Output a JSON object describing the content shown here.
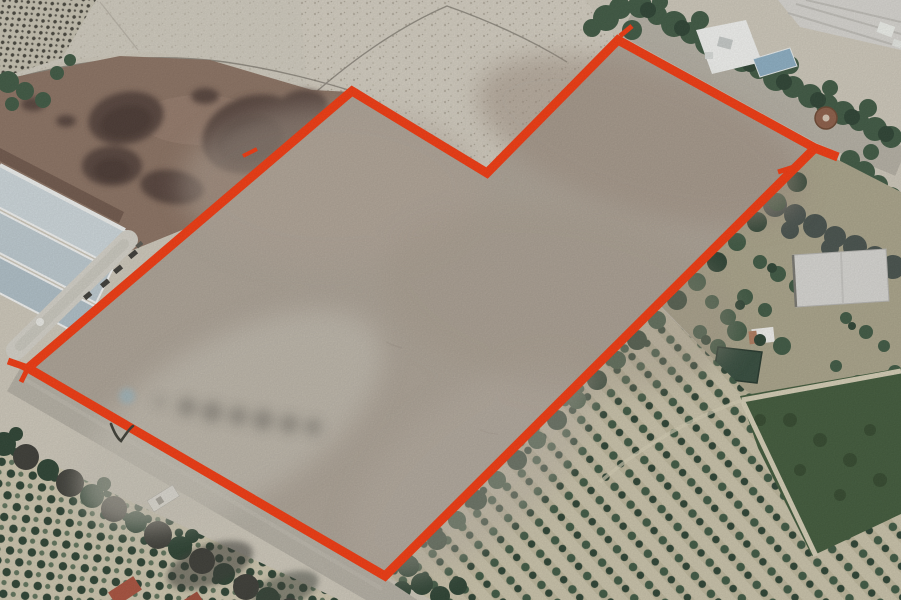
{
  "meta": {
    "width": 901,
    "height": 600,
    "description": "Aerial satellite view of farmland with a large land parcel outlined in red"
  },
  "colors": {
    "accent_red": "#f2380e",
    "parcel_base": "#aca295",
    "ground_pale": "#cdc7b9",
    "ground_speckle": "#d2ccbf",
    "field_brown": "#8a7161",
    "mud_dark": "#55423a",
    "mud_deep": "#43332d",
    "tree_green": "#3d5741",
    "tree_dark": "#2b4131",
    "orchard_ground": "#c9c2a9",
    "olive_ground": "#a9a389",
    "road_grey": "#b4afa3",
    "roof_blue": "#ccd6da",
    "roof_grey": "#d6d4cf",
    "pond_green": "#334a3b",
    "dense_field": "#3f5839",
    "blue_dot": "#9db3ba",
    "mark_dark": "#3c3c34",
    "smudge_dark": "#6e6a64"
  },
  "annotation": {
    "polygon_points": "352,91 487,173 618,40 815,148 385,576 28,368",
    "stroke_width": 9,
    "ticks": [
      {
        "x1": 815,
        "y1": 148,
        "x2": 838,
        "y2": 157,
        "w": 9
      },
      {
        "x1": 797,
        "y1": 166,
        "x2": 778,
        "y2": 172,
        "w": 5
      },
      {
        "x1": 28,
        "y1": 368,
        "x2": 8,
        "y2": 361,
        "w": 7
      },
      {
        "x1": 28,
        "y1": 368,
        "x2": 21,
        "y2": 382,
        "w": 5
      },
      {
        "x1": 243,
        "y1": 156,
        "x2": 257,
        "y2": 149,
        "w": 4
      },
      {
        "x1": 620,
        "y1": 36,
        "x2": 632,
        "y2": 26,
        "w": 5
      }
    ]
  },
  "markers": {
    "checkmark_path": "M111,424 C114,432 117,438 121,441 C125,435 129,429 133,426"
  }
}
